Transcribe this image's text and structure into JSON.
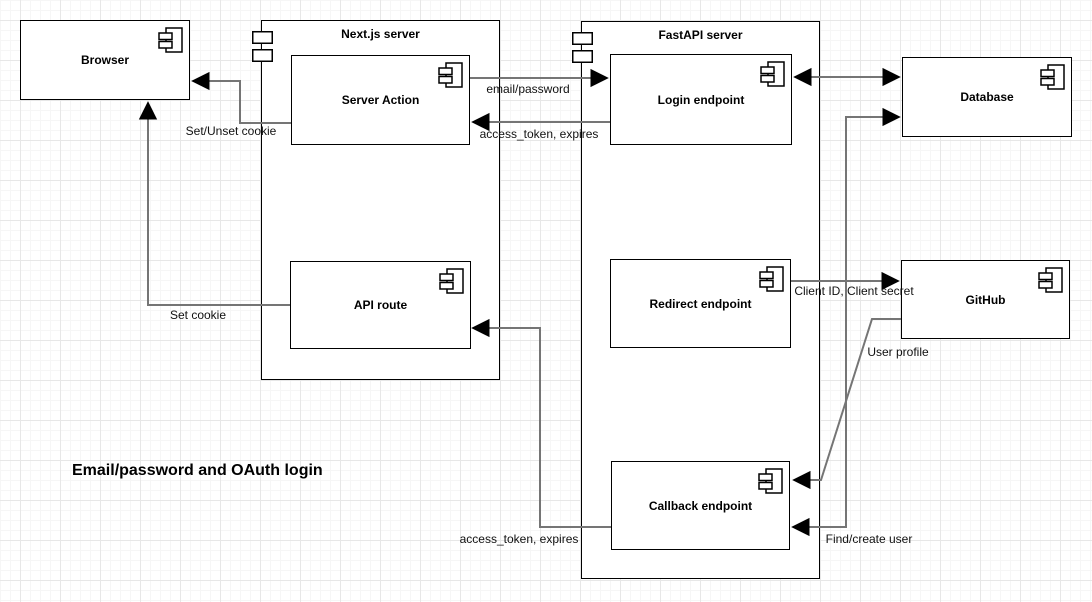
{
  "caption": "Email/password and OAuth login",
  "containers": [
    {
      "label": "Next.js server"
    },
    {
      "label": "FastAPI server"
    }
  ],
  "nodes": [
    {
      "label": "Browser"
    },
    {
      "label": "Server Action"
    },
    {
      "label": "API route"
    },
    {
      "label": "Login endpoint"
    },
    {
      "label": "Redirect endpoint"
    },
    {
      "label": "Callback endpoint"
    },
    {
      "label": "Database"
    },
    {
      "label": "GitHub"
    }
  ],
  "edges": [
    {
      "label": "email/password",
      "from": "Server Action",
      "to": "Login endpoint",
      "arrows": "end"
    },
    {
      "label": "access_token, expires",
      "from": "Login endpoint",
      "to": "Server Action",
      "arrows": "end"
    },
    {
      "label": "Set/Unset cookie",
      "from": "Server Action",
      "to": "Browser",
      "arrows": "end"
    },
    {
      "label": "Set cookie",
      "from": "API route",
      "to": "Browser",
      "arrows": "end"
    },
    {
      "label": "",
      "from": "Login endpoint",
      "to": "Database",
      "arrows": "both"
    },
    {
      "label": "Client ID, Client secret",
      "from": "Redirect endpoint",
      "to": "GitHub",
      "arrows": "end"
    },
    {
      "label": "User profile",
      "from": "GitHub",
      "to": "Callback endpoint",
      "arrows": "end"
    },
    {
      "label": "Find/create user",
      "from": "Callback endpoint",
      "to": "Database",
      "arrows": "both"
    },
    {
      "label": "access_token, expires",
      "from": "Callback endpoint",
      "to": "API route",
      "arrows": "end"
    }
  ],
  "colors": {
    "connector": "#757575",
    "arrowhead": "#000000",
    "node_border": "#000000",
    "node_fill": "#ffffff"
  }
}
